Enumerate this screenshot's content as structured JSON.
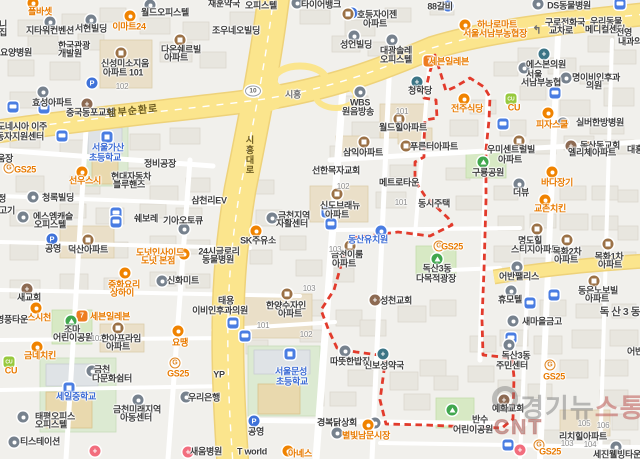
{
  "map": {
    "boundary_color": "#e23b2c",
    "road_shield": "10",
    "watermark": {
      "line1_left": "경기뉴",
      "line1_right": "스통신",
      "line2": "CNT"
    },
    "road_labels": [
      [
        "남부순환로",
        133,
        112,
        "rd",
        -6
      ],
      [
        "시흥",
        293,
        95,
        "rd2",
        0
      ],
      [
        "시흥대로",
        249,
        155,
        "rdv",
        0
      ]
    ],
    "labels": [
      [
        "폴바셋",
        40,
        12,
        "or"
      ],
      [
        "월드오피스텔",
        165,
        13
      ],
      [
        "재훈약국",
        224,
        4
      ],
      [
        "오피스텔",
        261,
        6
      ],
      [
        "타이어뱅크",
        321,
        5
      ],
      [
        "DS동물병원",
        569,
        6
      ],
      [
        "88갈비",
        440,
        7
      ],
      [
        "호등자이젠",
        377,
        15
      ],
      [
        "아파트",
        375,
        24
      ],
      [
        "지타워컨벤션",
        50,
        31
      ],
      [
        "서현빌딩",
        91,
        29
      ],
      [
        "이마트24",
        129,
        27,
        "or"
      ],
      [
        "조우네오빌딩",
        236,
        31
      ],
      [
        "성언빌딩",
        356,
        45
      ],
      [
        "대광솔레",
        396,
        51
      ],
      [
        "오피스텔",
        396,
        60
      ],
      [
        "하나로마트",
        497,
        25,
        "or"
      ],
      [
        "서울서남부농협장",
        495,
        34,
        "or"
      ],
      [
        "구로전화국",
        565,
        23
      ],
      [
        "교차로",
        561,
        31
      ],
      [
        "우리동물",
        606,
        22
      ],
      [
        "메디컬센터",
        605,
        30
      ],
      [
        "전영",
        624,
        33
      ],
      [
        "내과의",
        630,
        42
      ],
      [
        "한국관광",
        74,
        46
      ],
      [
        "개발원",
        70,
        54
      ],
      [
        "신성미소지움",
        125,
        64
      ],
      [
        "아파트 101",
        123,
        73
      ],
      [
        "102",
        122,
        87,
        "num"
      ],
      [
        "다온쉐르빌",
        181,
        50
      ],
      [
        "아파트",
        176,
        58
      ],
      [
        "요양병원",
        16,
        53
      ],
      [
        "니",
        3,
        25
      ],
      [
        "집",
        3,
        33
      ],
      [
        "효성아파트",
        52,
        103
      ],
      [
        "중국동포교회",
        90,
        113
      ],
      [
        "에스본의원",
        546,
        65
      ],
      [
        "서울",
        534,
        75
      ],
      [
        "서남부농협",
        541,
        83
      ],
      [
        "청학당",
        420,
        91
      ],
      [
        "전주식당",
        467,
        109,
        "or"
      ],
      [
        "CU",
        514,
        108,
        "or"
      ],
      [
        "피자스쿨",
        552,
        125,
        "or"
      ],
      [
        "명이비인후과",
        596,
        78
      ],
      [
        "의원",
        594,
        86
      ],
      [
        "실버한방병원",
        600,
        123
      ],
      [
        "독산동교회",
        600,
        146
      ],
      [
        "세븐일레븐",
        449,
        62,
        "or"
      ],
      [
        "WBS",
        360,
        103
      ],
      [
        "원음방송",
        358,
        112
      ],
      [
        "101",
        402,
        112,
        "num"
      ],
      [
        "월드힐아파트",
        403,
        128
      ],
      [
        "푸른터아파트",
        434,
        147
      ],
      [
        "삼익아파트",
        363,
        153
      ],
      [
        "메트로타운",
        399,
        183
      ],
      [
        "선한목자교회",
        336,
        171
      ],
      [
        "102",
        343,
        187,
        "num"
      ],
      [
        "101",
        401,
        203,
        "num"
      ],
      [
        "신도브래뉴",
        340,
        206
      ],
      [
        "아파트",
        337,
        215
      ],
      [
        "금천지역",
        294,
        216
      ],
      [
        "자활센터",
        292,
        224
      ],
      [
        "우미센트럴빌",
        511,
        150
      ],
      [
        "아파트",
        510,
        160
      ],
      [
        "엘리체아파트",
        592,
        153
      ],
      [
        "대흥",
        635,
        150
      ],
      [
        "구룡공원",
        488,
        173
      ],
      [
        "바다장기",
        557,
        183,
        "or"
      ],
      [
        "더뷰",
        521,
        193
      ],
      [
        "교촌치킨",
        550,
        209,
        "or"
      ],
      [
        "동시주택",
        434,
        204
      ],
      [
        "명도힐",
        530,
        241
      ],
      [
        "스티지아파트",
        535,
        250
      ],
      [
        "목화2차",
        567,
        252
      ],
      [
        "아파트",
        566,
        260
      ],
      [
        "목화1차",
        609,
        257
      ],
      [
        "아파트",
        610,
        265
      ],
      [
        "동은노보빌",
        598,
        291
      ],
      [
        "아파트",
        597,
        299
      ],
      [
        "어반팰리스",
        519,
        277
      ],
      [
        "휴모텔",
        510,
        300
      ],
      [
        "GS25",
        452,
        247,
        "or"
      ],
      [
        "동산유치원",
        368,
        240,
        "bl"
      ],
      [
        "금천이룸",
        347,
        255
      ],
      [
        "아파트",
        344,
        264
      ],
      [
        "103",
        335,
        250,
        "num"
      ],
      [
        "103",
        309,
        289,
        "num"
      ],
      [
        "SK주유소",
        258,
        241
      ],
      [
        "24시글로리",
        219,
        252
      ],
      [
        "동물병원",
        218,
        260
      ],
      [
        "삼천리EV",
        209,
        201
      ],
      [
        "쉐보레",
        146,
        219
      ],
      [
        "기아오토큐",
        183,
        221
      ],
      [
        "현대자동차",
        131,
        177
      ],
      [
        "블루핸즈",
        129,
        185
      ],
      [
        "정비공장",
        160,
        164
      ],
      [
        "청록빌딩",
        58,
        198
      ],
      [
        "에스엠캐슬",
        53,
        217
      ],
      [
        "오피스텔",
        50,
        225
      ],
      [
        "덕산아파트",
        88,
        250
      ],
      [
        "공영",
        53,
        249
      ],
      [
        "선우스시",
        85,
        181,
        "or"
      ],
      [
        "도넛인사이드",
        160,
        253,
        "or"
      ],
      [
        "도넛 본점",
        158,
        261,
        "or"
      ],
      [
        "신화미트",
        183,
        281
      ],
      [
        "중화요리",
        124,
        285,
        "or"
      ],
      [
        "상하이",
        122,
        293,
        "or"
      ],
      [
        "새교회",
        29,
        298
      ],
      [
        "움장",
        5,
        159
      ],
      [
        "정",
        2,
        199
      ],
      [
        "고기",
        7,
        211
      ],
      [
        "GS25",
        25,
        170,
        "or"
      ],
      [
        "도네시아 이주",
        22,
        127
      ],
      [
        "동자지원센터",
        20,
        137
      ],
      [
        "서울가산",
        108,
        148,
        "bl"
      ],
      [
        "초등학교",
        105,
        158,
        "bl"
      ],
      [
        "태용",
        226,
        301
      ],
      [
        "이비인후과의원",
        220,
        311
      ],
      [
        "한양수자인",
        286,
        306
      ],
      [
        "아파트",
        290,
        314
      ],
      [
        "101",
        263,
        326,
        "num"
      ],
      [
        "102",
        306,
        335,
        "num"
      ],
      [
        "YP",
        219,
        375
      ],
      [
        "서울문성",
        291,
        372,
        "bl"
      ],
      [
        "초등학교",
        292,
        382,
        "bl"
      ],
      [
        "따뜻한밥집",
        350,
        362
      ],
      [
        "신보성약국",
        384,
        366
      ],
      [
        "경복닭상회",
        337,
        423
      ],
      [
        "별빛남문시장",
        366,
        436,
        "or"
      ],
      [
        "공영",
        256,
        432
      ],
      [
        "T world",
        252,
        452
      ],
      [
        "아녜스",
        300,
        454,
        "or"
      ],
      [
        "스시천",
        39,
        318,
        "or"
      ],
      [
        "영풍타운",
        12,
        320
      ],
      [
        "세븐일레븐",
        110,
        317,
        "or"
      ],
      [
        "조마",
        72,
        330
      ],
      [
        "어린이공원",
        73,
        338
      ],
      [
        "102",
        97,
        339,
        "num"
      ],
      [
        "한아프라임",
        121,
        339
      ],
      [
        "아파트",
        118,
        347
      ],
      [
        "금네치킨",
        40,
        356,
        "or"
      ],
      [
        "CU",
        11,
        371,
        "or"
      ],
      [
        "금천",
        102,
        370
      ],
      [
        "다문화쉼터",
        112,
        379
      ],
      [
        "GS25",
        178,
        374,
        "or"
      ],
      [
        "요땡",
        180,
        343,
        "or"
      ],
      [
        "세일중학교",
        76,
        397,
        "bl"
      ],
      [
        "태평오피스",
        55,
        417
      ],
      [
        "오피스텔",
        51,
        425
      ],
      [
        "티스테이션",
        40,
        442
      ],
      [
        "우리은행",
        204,
        398
      ],
      [
        "새움병원",
        206,
        452
      ],
      [
        "금천미래지역",
        137,
        410
      ],
      [
        "아동센터",
        136,
        418
      ],
      [
        "리치힐아파트",
        583,
        437
      ],
      [
        "103",
        567,
        444,
        "num"
      ],
      [
        "104",
        590,
        445,
        "num"
      ],
      [
        "105",
        584,
        424,
        "num"
      ],
      [
        "106",
        603,
        426,
        "num"
      ],
      [
        "세진웰빙타운",
        617,
        455
      ],
      [
        "GS25",
        550,
        452,
        "or"
      ],
      [
        "새마을금고",
        542,
        322
      ],
      [
        "독산3동",
        516,
        356
      ],
      [
        "주민센터",
        512,
        366
      ],
      [
        "GS25",
        554,
        377,
        "or"
      ],
      [
        "예화교회",
        508,
        409
      ],
      [
        "반수",
        480,
        420
      ],
      [
        "어린이공원",
        473,
        430
      ],
      [
        "독산3동",
        621,
        312,
        "di"
      ],
      [
        "어반",
        635,
        352
      ],
      [
        "성천교회",
        396,
        301
      ],
      [
        "독산3동",
        437,
        269
      ],
      [
        "다목적광장",
        436,
        279
      ]
    ],
    "icons": [
      [
        13,
        107,
        "bus"
      ],
      [
        44,
        108,
        "bus"
      ],
      [
        62,
        136,
        "bus"
      ],
      [
        116,
        213,
        "bus"
      ],
      [
        116,
        222,
        "bus"
      ],
      [
        327,
        212,
        "bus"
      ],
      [
        331,
        224,
        "bus"
      ],
      [
        233,
        323,
        "bus"
      ],
      [
        245,
        336,
        "bus"
      ],
      [
        503,
        124,
        "bus"
      ],
      [
        555,
        93,
        "bus"
      ],
      [
        554,
        295,
        "bus"
      ],
      [
        530,
        303,
        "bus"
      ],
      [
        511,
        338,
        "bus"
      ],
      [
        508,
        445,
        "bus"
      ],
      [
        620,
        4,
        "bus"
      ],
      [
        92,
        83,
        "p"
      ],
      [
        448,
        6,
        "p"
      ],
      [
        52,
        239,
        "p"
      ],
      [
        254,
        421,
        "p"
      ],
      [
        352,
        13,
        "p"
      ],
      [
        121,
        53,
        "apt"
      ],
      [
        180,
        40,
        "apt"
      ],
      [
        348,
        14,
        "apt"
      ],
      [
        399,
        119,
        "apt"
      ],
      [
        406,
        146,
        "apt"
      ],
      [
        364,
        142,
        "apt"
      ],
      [
        337,
        194,
        "apt"
      ],
      [
        350,
        246,
        "apt"
      ],
      [
        287,
        294,
        "apt"
      ],
      [
        519,
        141,
        "apt"
      ],
      [
        588,
        147,
        "apt"
      ],
      [
        537,
        229,
        "apt"
      ],
      [
        567,
        240,
        "apt"
      ],
      [
        608,
        244,
        "apt"
      ],
      [
        594,
        281,
        "apt"
      ],
      [
        118,
        328,
        "apt"
      ],
      [
        88,
        240,
        "apt"
      ],
      [
        150,
        5,
        "bld"
      ],
      [
        91,
        20,
        "bld"
      ],
      [
        50,
        22,
        "bld"
      ],
      [
        354,
        36,
        "bld"
      ],
      [
        392,
        40,
        "bld"
      ],
      [
        33,
        197,
        "bld"
      ],
      [
        23,
        217,
        "bld"
      ],
      [
        272,
        218,
        "bld"
      ],
      [
        360,
        92,
        "bld"
      ],
      [
        517,
        267,
        "bld"
      ],
      [
        511,
        291,
        "bld"
      ],
      [
        519,
        184,
        "bld"
      ],
      [
        162,
        281,
        "bld"
      ],
      [
        92,
        371,
        "bld"
      ],
      [
        138,
        400,
        "bld"
      ],
      [
        23,
        417,
        "bld"
      ],
      [
        14,
        442,
        "bld"
      ],
      [
        186,
        397,
        "bld"
      ],
      [
        513,
        321,
        "bld"
      ],
      [
        566,
        78,
        "bld"
      ],
      [
        563,
        123,
        "bld"
      ],
      [
        337,
        433,
        "bld"
      ],
      [
        375,
        423,
        "bld"
      ],
      [
        524,
        68,
        "bld"
      ],
      [
        509,
        345,
        "bld"
      ],
      [
        345,
        351,
        "bld"
      ],
      [
        616,
        447,
        "bld"
      ],
      [
        538,
        4,
        "bld"
      ],
      [
        297,
        3,
        "bld"
      ],
      [
        184,
        229,
        "bld"
      ],
      [
        87,
        104,
        "ch"
      ],
      [
        27,
        289,
        "ch"
      ],
      [
        375,
        300,
        "ch"
      ],
      [
        571,
        146,
        "ch"
      ],
      [
        504,
        400,
        "ch"
      ],
      [
        544,
        54,
        "med"
      ],
      [
        417,
        82,
        "med"
      ],
      [
        383,
        354,
        "med"
      ],
      [
        43,
        92,
        "bld"
      ],
      [
        95,
        451,
        "medr"
      ],
      [
        188,
        452,
        "medr"
      ],
      [
        520,
        450,
        "medr"
      ],
      [
        33,
        3,
        "food"
      ],
      [
        36,
        308,
        "food"
      ],
      [
        37,
        347,
        "food"
      ],
      [
        178,
        331,
        "food"
      ],
      [
        184,
        254,
        "food"
      ],
      [
        125,
        273,
        "food"
      ],
      [
        368,
        425,
        "food"
      ],
      [
        288,
        451,
        "food"
      ],
      [
        82,
        172,
        "food"
      ],
      [
        464,
        99,
        "food"
      ],
      [
        552,
        172,
        "food"
      ],
      [
        545,
        200,
        "food"
      ],
      [
        548,
        113,
        "food"
      ],
      [
        465,
        25,
        "food"
      ],
      [
        130,
        16,
        "food"
      ],
      [
        256,
        231,
        "food"
      ],
      [
        439,
        246,
        "gs"
      ],
      [
        550,
        365,
        "gs"
      ],
      [
        539,
        445,
        "gs"
      ],
      [
        175,
        363,
        "gs"
      ],
      [
        9,
        168,
        "gs"
      ],
      [
        511,
        99,
        "cu"
      ],
      [
        9,
        362,
        "cu"
      ],
      [
        82,
        316,
        "sev"
      ],
      [
        429,
        61,
        "sev"
      ],
      [
        107,
        137,
        "sch"
      ],
      [
        290,
        354,
        "sch"
      ],
      [
        69,
        388,
        "sch"
      ],
      [
        381,
        231,
        "kin"
      ],
      [
        71,
        321,
        "park"
      ],
      [
        483,
        162,
        "park"
      ],
      [
        437,
        259,
        "park"
      ],
      [
        452,
        410,
        "park"
      ],
      [
        253,
        91,
        "shield"
      ],
      [
        537,
        30,
        "arrow"
      ]
    ]
  }
}
